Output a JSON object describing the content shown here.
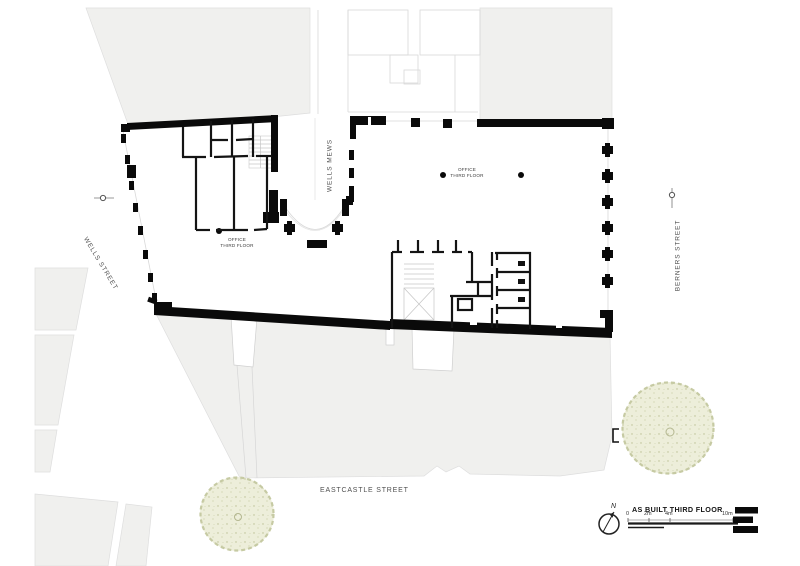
{
  "drawing": {
    "title": "AS BUILT THIRD FLOOR",
    "north_label": "N"
  },
  "streets": {
    "wells_street": "WELLS STREET",
    "wells_mews": "WELLS MEWS",
    "berners_street": "BERNERS STREET",
    "eastcastle_street": "EASTCASTLE STREET"
  },
  "office_labels": [
    {
      "line1": "OFFICE",
      "line2": "THIRD FLOOR"
    },
    {
      "line1": "OFFICE",
      "line2": "THIRD FLOOR"
    }
  ],
  "scale_bar": {
    "labels": [
      "0",
      "2m",
      "4m",
      "10m"
    ]
  },
  "colors": {
    "context_building_fill": "#f0f0ee",
    "wall_black": "#0a0a0a",
    "tree_fill": "#edeeda",
    "tree_speckle": "#b9bd92",
    "faint_line": "#d8d8d8"
  },
  "icons": {
    "north_arrow": "north-arrow-icon",
    "lamp": "lamp-icon",
    "tree": "tree-icon",
    "stair": "stair-icon",
    "lift": "lift-icon",
    "logo": "logo-mark"
  }
}
